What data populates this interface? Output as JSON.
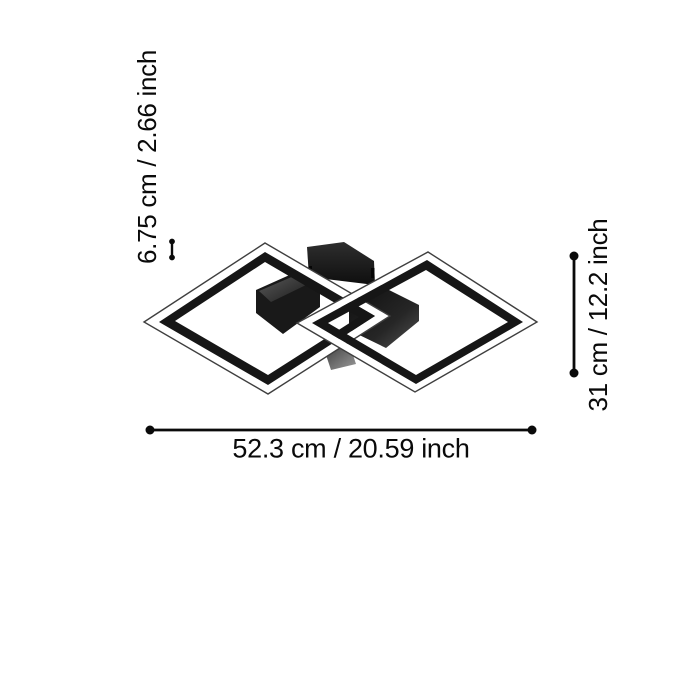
{
  "diagram": {
    "background_color": "#ffffff",
    "ink_color": "#0a0a0a",
    "lamp": {
      "frame_color": "#161616",
      "diffuser_color": "#ffffff",
      "canopy_color": "#1b1b1b",
      "connector_color": "#8a8a8a"
    },
    "dimensions": {
      "height_label": "6.75 cm / 2.66 inch",
      "depth_label": "31 cm / 12.2 inch",
      "width_label": "52.3 cm / 20.59 inch"
    }
  }
}
